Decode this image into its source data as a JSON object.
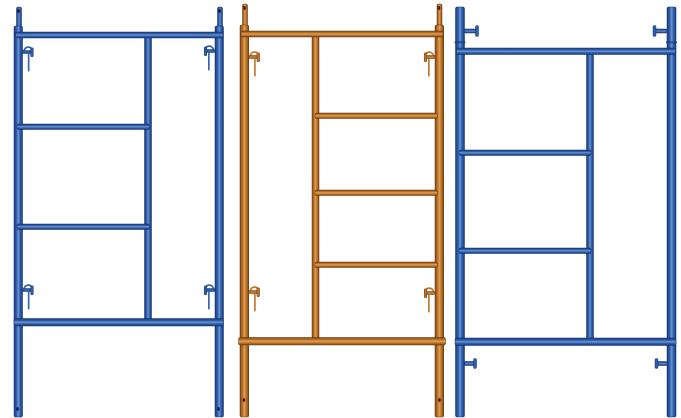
{
  "image": {
    "subject": "Product photo: three steel mason walk-through scaffolding frames, blue, orange, blue, on white background",
    "width": 681,
    "height": 418,
    "background": "#ffffff"
  },
  "frames": [
    {
      "name": "frame-left-blue",
      "label": "Blue scaffold frame with two ladder rungs on left half and spring lock clips",
      "colors": {
        "outline": "#122c5e",
        "dark": "#1b3c7a",
        "mid": "#2d5fae",
        "light": "#6f94cf",
        "hole": "#0c1e42"
      },
      "verticals": [
        {
          "name": "left-coupling-pin",
          "x": 16.5,
          "w": 5,
          "y1": 7,
          "y2": 29
        },
        {
          "name": "right-coupling-pin",
          "x": 217.5,
          "w": 5,
          "y1": 7,
          "y2": 29
        },
        {
          "name": "left-post",
          "x": 14,
          "w": 8.5,
          "y1": 26,
          "y2": 417
        },
        {
          "name": "right-post",
          "x": 215,
          "w": 8.5,
          "y1": 26,
          "y2": 417
        },
        {
          "name": "center-upright",
          "x": 144.5,
          "w": 7,
          "y1": 34,
          "y2": 323
        }
      ],
      "horizontals": [
        {
          "name": "top-ledger",
          "x1": 15.5,
          "x2": 223,
          "y": 32,
          "h": 6
        },
        {
          "name": "upper-rung",
          "x1": 17,
          "x2": 149.5,
          "y": 124,
          "h": 5.5
        },
        {
          "name": "lower-rung",
          "x1": 17,
          "x2": 149.5,
          "y": 224,
          "h": 5.5
        },
        {
          "name": "bottom-ledger",
          "x1": 14,
          "x2": 223.5,
          "y": 318.5,
          "h": 7.5
        }
      ],
      "clips": [
        {
          "name": "lock-clip-top-left",
          "x": 22.5,
          "y": 45,
          "dir": 1
        },
        {
          "name": "lock-clip-top-right",
          "x": 215,
          "y": 44,
          "dir": -1
        },
        {
          "name": "lock-clip-bottom-left",
          "x": 22.5,
          "y": 283,
          "dir": 1
        },
        {
          "name": "lock-clip-bottom-right",
          "x": 215,
          "y": 283,
          "dir": -1
        }
      ],
      "studs": [],
      "joints": [],
      "holes": [
        {
          "x": 18.5,
          "y": 11
        },
        {
          "x": 219.5,
          "y": 11
        },
        {
          "x": 17.5,
          "y": 409
        },
        {
          "x": 218.5,
          "y": 409
        }
      ]
    },
    {
      "name": "frame-middle-orange",
      "label": "Orange scaffold ladder frame with three rungs on right half and spring lock clips",
      "colors": {
        "outline": "#5e3410",
        "dark": "#7c4614",
        "mid": "#bf7428",
        "light": "#dfa055",
        "hole": "#3a1d06"
      },
      "verticals": [
        {
          "name": "left-coupling-pin",
          "x": 242.5,
          "w": 5,
          "y1": 4,
          "y2": 27
        },
        {
          "name": "right-coupling-pin",
          "x": 437,
          "w": 5,
          "y1": 4,
          "y2": 27
        },
        {
          "name": "left-post",
          "x": 240,
          "w": 8.75,
          "y1": 25,
          "y2": 417
        },
        {
          "name": "right-post",
          "x": 435,
          "w": 8.75,
          "y1": 25,
          "y2": 417
        },
        {
          "name": "center-upright",
          "x": 312,
          "w": 7,
          "y1": 33,
          "y2": 341
        }
      ],
      "horizontals": [
        {
          "name": "top-ledger",
          "x1": 241,
          "x2": 443,
          "y": 31,
          "h": 6
        },
        {
          "name": "rung-1",
          "x1": 315,
          "x2": 437.5,
          "y": 113,
          "h": 5.5
        },
        {
          "name": "rung-2",
          "x1": 315,
          "x2": 437.5,
          "y": 190,
          "h": 5.5
        },
        {
          "name": "rung-3",
          "x1": 315,
          "x2": 437.5,
          "y": 262,
          "h": 5.5
        },
        {
          "name": "bottom-ledger",
          "x1": 238.5,
          "x2": 445.5,
          "y": 337.5,
          "h": 7.5
        }
      ],
      "clips": [
        {
          "name": "lock-clip-top-left",
          "x": 248.75,
          "y": 50,
          "dir": 1
        },
        {
          "name": "lock-clip-top-right",
          "x": 435,
          "y": 50,
          "dir": -1
        },
        {
          "name": "lock-clip-bottom-left",
          "x": 248.75,
          "y": 285,
          "dir": 1
        },
        {
          "name": "lock-clip-bottom-right",
          "x": 435,
          "y": 286,
          "dir": -1
        }
      ],
      "studs": [],
      "joints": [],
      "holes": [
        {
          "x": 244.5,
          "y": 8
        },
        {
          "x": 439,
          "y": 8
        },
        {
          "x": 244,
          "y": 400
        },
        {
          "x": 439.5,
          "y": 400
        }
      ]
    },
    {
      "name": "frame-right-blue",
      "label": "Blue scaffold frame with two rungs on left half, posts extended above top ledger with side studs",
      "colors": {
        "outline": "#122c5e",
        "dark": "#1b3c7a",
        "mid": "#2d5fae",
        "light": "#6f94cf",
        "hole": "#0c1e42"
      },
      "verticals": [
        {
          "name": "left-post",
          "x": 455.5,
          "w": 9,
          "y1": 7,
          "y2": 417
        },
        {
          "name": "right-post",
          "x": 667,
          "w": 9,
          "y1": 7,
          "y2": 417
        },
        {
          "name": "center-upright",
          "x": 586.5,
          "w": 7,
          "y1": 54,
          "y2": 341
        }
      ],
      "horizontals": [
        {
          "name": "top-ledger",
          "x1": 456.5,
          "x2": 675.5,
          "y": 48,
          "h": 6.5
        },
        {
          "name": "upper-rung",
          "x1": 459,
          "x2": 591,
          "y": 150,
          "h": 5.5
        },
        {
          "name": "lower-rung",
          "x1": 459,
          "x2": 591,
          "y": 248,
          "h": 5.5
        },
        {
          "name": "bottom-ledger",
          "x1": 455,
          "x2": 676,
          "y": 338,
          "h": 7.5
        }
      ],
      "clips": [],
      "studs": [
        {
          "name": "stud-top-left",
          "x": 464.5,
          "y": 27.5,
          "dir": 1,
          "len": 13,
          "pinH": 4,
          "capH": 11
        },
        {
          "name": "stud-top-right",
          "x": 667,
          "y": 27.5,
          "dir": -1,
          "len": 13,
          "pinH": 4,
          "capH": 11
        },
        {
          "name": "stud-bottom-left",
          "x": 464.5,
          "y": 360,
          "dir": 1,
          "len": 11,
          "pinH": 4,
          "capH": 10
        },
        {
          "name": "stud-bottom-right",
          "x": 667,
          "y": 360,
          "dir": -1,
          "len": 11,
          "pinH": 4,
          "capH": 10
        }
      ],
      "joints": [
        {
          "name": "collar-seam-left",
          "x": 454.5,
          "y": 41,
          "w": 11,
          "h": 2.5
        },
        {
          "name": "collar-seam-right",
          "x": 666,
          "y": 41,
          "w": 11,
          "h": 2.5
        }
      ],
      "holes": []
    }
  ]
}
